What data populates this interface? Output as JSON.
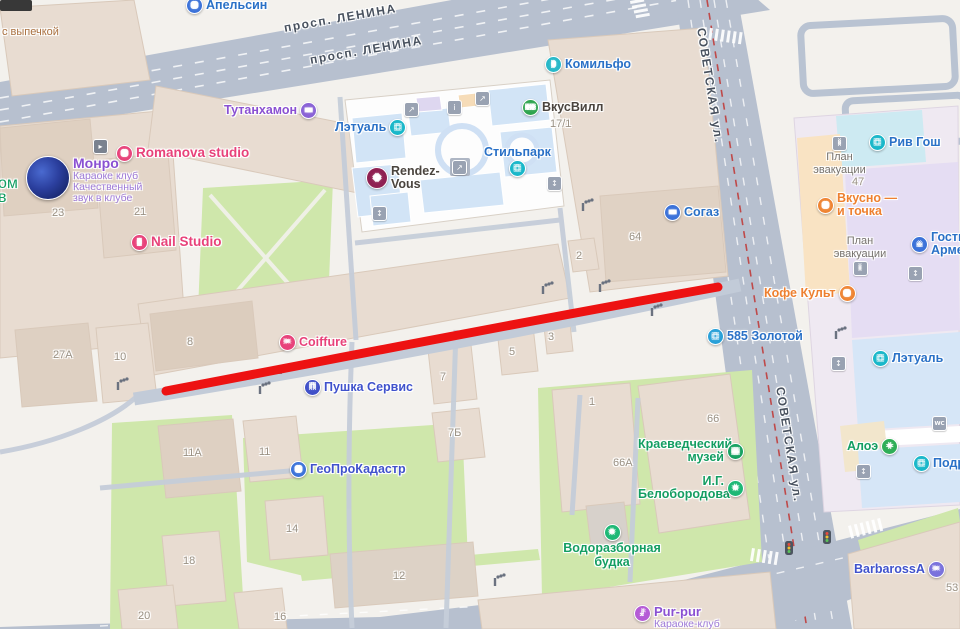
{
  "streets": {
    "lenina": "просп. ЛЕНИНА",
    "sovetskaya": "СОВЕТСКАЯ ул."
  },
  "colors": {
    "route_red": "#ed1212",
    "road": "#b7c0cf",
    "tram_line": "#bf4949",
    "park": "#cfe7ab",
    "building": "#e8dcd1",
    "mall_room": "#d2e4f6",
    "accent_blue": "#2a71c7"
  },
  "icons": {
    "escalator": "↗",
    "elevator": "↕",
    "info": "i",
    "wc": "WC",
    "entrance": "▸"
  },
  "pois": {
    "apelsin": {
      "label": "Апельсин",
      "glyph": "●"
    },
    "bakery": {
      "label": "с выпечкой"
    },
    "komilfo": {
      "label": "Комильфо",
      "glyph": "◗"
    },
    "vkusvill": {
      "label": "ВкусВилл",
      "glyph": "ВВ"
    },
    "tutankhamon": {
      "label": "Тутанхамон",
      "glyph": "▬"
    },
    "letual_top": {
      "label": "Лэтуаль",
      "glyph": "◻"
    },
    "rendezvous": {
      "line1": "Rendez-",
      "line2": "Vous",
      "glyph": "◆"
    },
    "stilpark": {
      "label": "Стильпарк",
      "glyph": "◻"
    },
    "monro": {
      "label": "Монро",
      "sub1": "Караоке клуб",
      "sub2": "Качественный",
      "sub3": "звук в клубе"
    },
    "romanova": {
      "label": "Romanova studio",
      "glyph": "●"
    },
    "nail": {
      "label": "Nail Studio",
      "glyph": "▮"
    },
    "sogaz": {
      "label": "Согаз",
      "glyph": "▬"
    },
    "coiffure": {
      "label": "Coiffure",
      "glyph": "✂"
    },
    "pushka": {
      "label": "Пушка Сервис",
      "glyph": "П"
    },
    "zolotoy": {
      "label": "585 Золотой",
      "glyph": "◻"
    },
    "kofekult": {
      "label": "Кофе Культ",
      "glyph": "●"
    },
    "rivgosh": {
      "label": "Рив Гош",
      "glyph": "◻"
    },
    "plan1": {
      "line1": "План",
      "line2": "эвакуации",
      "glyph": "i"
    },
    "vkusno": {
      "line1": "Вкусно —",
      "line2": "и точка",
      "glyph": "●"
    },
    "plan2": {
      "line1": "План",
      "line2": "эвакуации",
      "glyph": "i"
    },
    "gostinitsa": {
      "line1": "Гости",
      "line2": "Арме",
      "glyph": "⌂"
    },
    "letual_right": {
      "label": "Лэтуаль",
      "glyph": "◻"
    },
    "aloe": {
      "label": "Алоэ",
      "glyph": "+"
    },
    "podruzhka": {
      "label": "Подр",
      "glyph": "◻"
    },
    "geo": {
      "label": "ГеоПроКадастр",
      "glyph": "●"
    },
    "muzey": {
      "line1": "Краеведческий",
      "line2": "музей",
      "glyph": "▦"
    },
    "belo": {
      "line1": "И.Г.",
      "line2": "Белобородова",
      "glyph": "★"
    },
    "budka": {
      "line1": "Водоразборная",
      "line2": "будка",
      "glyph": "★"
    },
    "barbarossa": {
      "label": "BarbarossA",
      "glyph": "✂"
    },
    "purpur": {
      "label": "Pur-pur",
      "sub": "Караоке-клуб",
      "glyph": "♪"
    },
    "frag_om": {
      "label": "ом"
    },
    "frag_v": {
      "label": "в"
    }
  },
  "houses": {
    "h23": "23",
    "h21": "21",
    "h17_1": "17/1",
    "h64": "64",
    "h2": "2",
    "h27a": "27А",
    "h10": "10",
    "h8": "8",
    "h7": "7",
    "h5": "5",
    "h3": "3",
    "h7b": "7Б",
    "h66": "66",
    "h1": "1",
    "h66a": "66А",
    "h11a": "11А",
    "h11": "11",
    "h14": "14",
    "h18": "18",
    "h20": "20",
    "h16": "16",
    "h12": "12",
    "h47": "47",
    "h53": "53"
  }
}
